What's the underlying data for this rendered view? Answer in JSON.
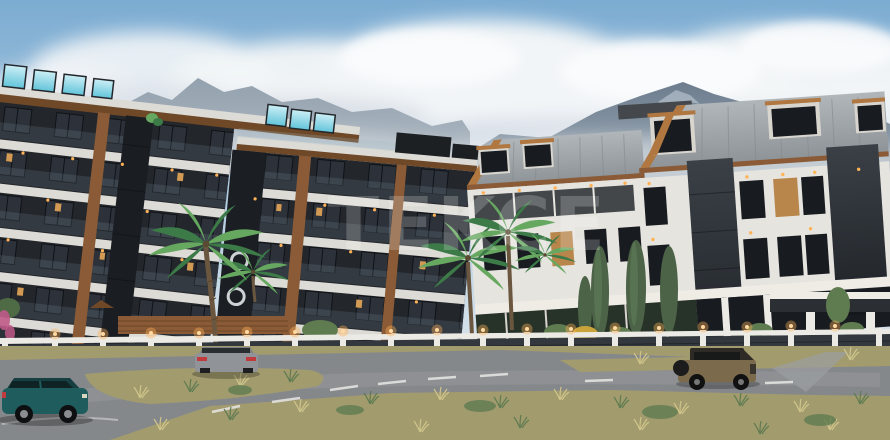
{
  "scene": {
    "type": "architectural-render"
  },
  "watermark": {
    "text": "TEKCE",
    "opacity": "0.20"
  },
  "palette": {
    "sky_top": "#7cacd2",
    "sky_mid": "#b9d0e2",
    "sky_horizon": "#dde6ed",
    "cloud_white": "#f2f5f7",
    "cloud_shadow": "#c3ced9",
    "mountain_far_top": "#93a1ae",
    "mountain_far_base": "#b3bdc6",
    "mountain_near_top": "#6d7d8e",
    "mountain_near_base": "#9fadb9",
    "building_dark": "#23262b",
    "building_dark2": "#1a1d22",
    "slab_white": "#dcdbd5",
    "facade_white": "#e6e4df",
    "wood": "#8a5b36",
    "wood_dark": "#6e4827",
    "wood_light": "#b07740",
    "glass_blue": "#62c4da",
    "glass_blue_light": "#cdeff6",
    "window_dark": "#181c21",
    "window_lit": "#d29a52",
    "roof_gray": "#9ba1a5",
    "stone_dark": "#33383e",
    "fence_white": "#eceae4",
    "lamp_glow": "#ffb257",
    "palm_green": "#3c7a48",
    "palm_green_light": "#67a860",
    "cypress_green": "#4c6347",
    "grass_olive": "#a29b6e",
    "grass_light": "#cfc48a",
    "bush_green": "#5f7c50",
    "bush_yellow": "#c9a43a",
    "flower_pink": "#c05a8a",
    "road_gray": "#85888b",
    "road_light": "#9b9ea1",
    "lane_white": "#e8e8e6",
    "car_teal": "#1f5c5e",
    "car_teal_dark": "#153f41",
    "car_gray": "#909398",
    "car_jeep": "#7b6a4c",
    "taillight_red": "#c13a3e",
    "watermark_white": "#ffffff"
  }
}
